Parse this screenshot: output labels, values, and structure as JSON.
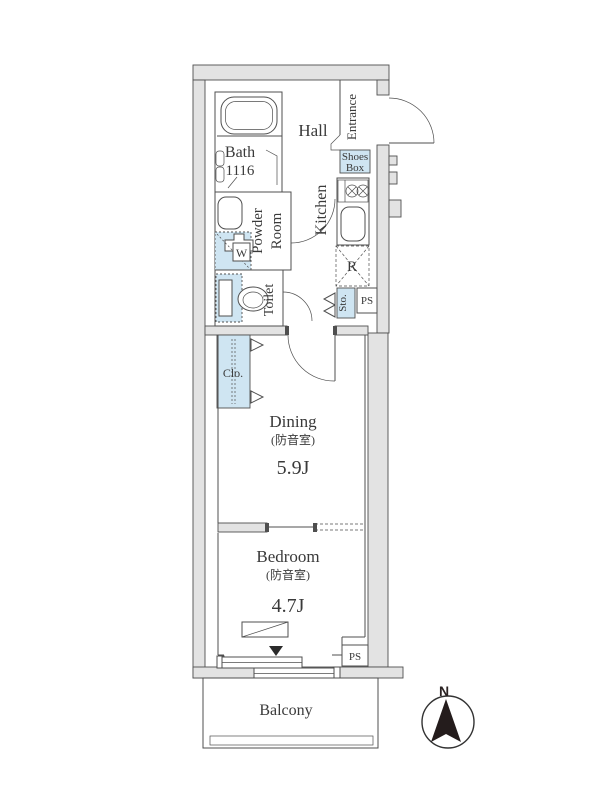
{
  "floorplan": {
    "bath": {
      "label": "Bath",
      "dim": "1116"
    },
    "hall": {
      "label": "Hall"
    },
    "entrance": {
      "label": "Entrance"
    },
    "shoes_box": {
      "line1": "Shoes",
      "line2": "Box"
    },
    "kitchen": {
      "label": "Kitchen"
    },
    "fridge": {
      "label": "R"
    },
    "powder_room": {
      "line1": "Powder",
      "line2": "Room"
    },
    "washer": {
      "label": "W"
    },
    "toilet": {
      "label": "Toilet"
    },
    "storage": {
      "label": "Sto."
    },
    "pipe_space_upper": {
      "label": "PS"
    },
    "closet": {
      "label": "Clo."
    },
    "dining": {
      "label": "Dining",
      "note": "(防音室)",
      "area": "5.9J"
    },
    "bedroom": {
      "label": "Bedroom",
      "note": "(防音室)",
      "area": "4.7J"
    },
    "pipe_space_lower": {
      "label": "PS"
    },
    "balcony": {
      "label": "Balcony"
    },
    "compass": {
      "label": "N"
    },
    "colors": {
      "wall_fill": "#e3e3e3",
      "fixture_blue": "#cfe5f2",
      "line": "#4a4a4a",
      "text": "#3a3a3a"
    }
  }
}
